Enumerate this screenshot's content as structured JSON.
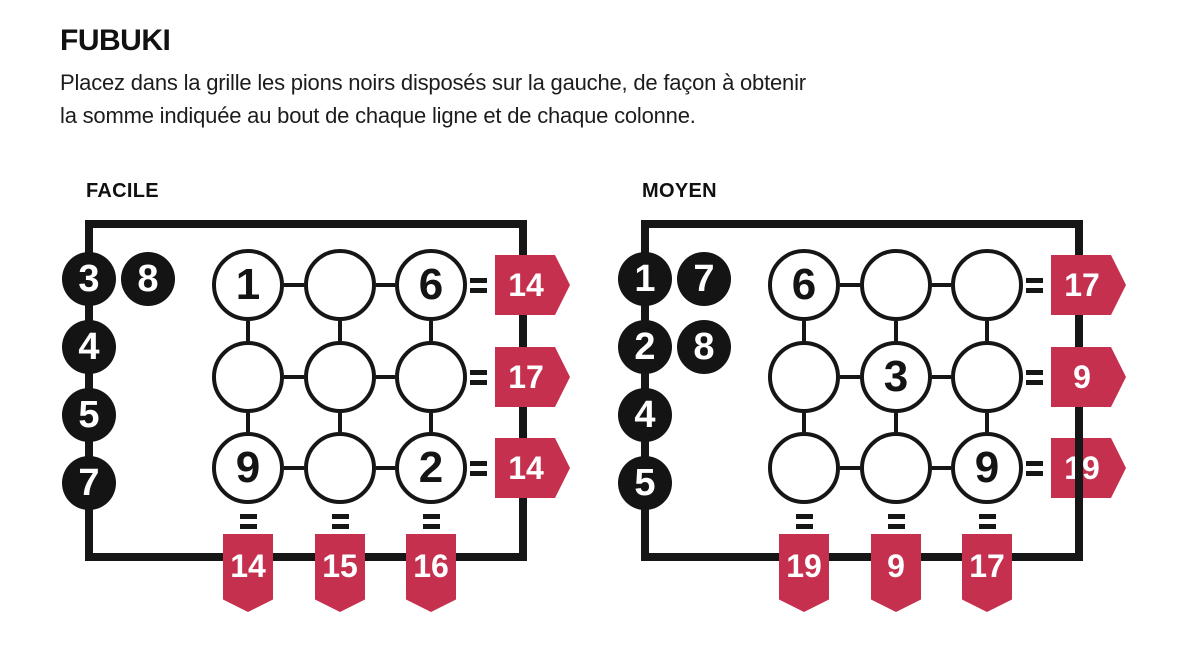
{
  "page": {
    "title": "FUBUKI",
    "instructions_line1": "Placez dans la grille les pions noirs disposés sur la gauche, de façon à obtenir",
    "instructions_line2": "la somme indiquée au bout de chaque ligne et de chaque colonne.",
    "colors": {
      "accent_red": "#c5304e",
      "ink_black": "#161616"
    }
  },
  "puzzles": [
    {
      "label": "FACILE",
      "tokens": [
        "3",
        "8",
        "4",
        "5",
        "7"
      ],
      "grid": [
        [
          "1",
          "",
          "6"
        ],
        [
          "",
          "",
          ""
        ],
        [
          "9",
          "",
          "2"
        ]
      ],
      "row_sums": [
        "14",
        "17",
        "14"
      ],
      "col_sums": [
        "14",
        "15",
        "16"
      ]
    },
    {
      "label": "MOYEN",
      "tokens": [
        "1",
        "7",
        "2",
        "8",
        "4",
        "5"
      ],
      "grid": [
        [
          "6",
          "",
          ""
        ],
        [
          "",
          "3",
          ""
        ],
        [
          "",
          "",
          "9"
        ]
      ],
      "row_sums": [
        "17",
        "9",
        "19"
      ],
      "col_sums": [
        "19",
        "9",
        "17"
      ]
    }
  ]
}
